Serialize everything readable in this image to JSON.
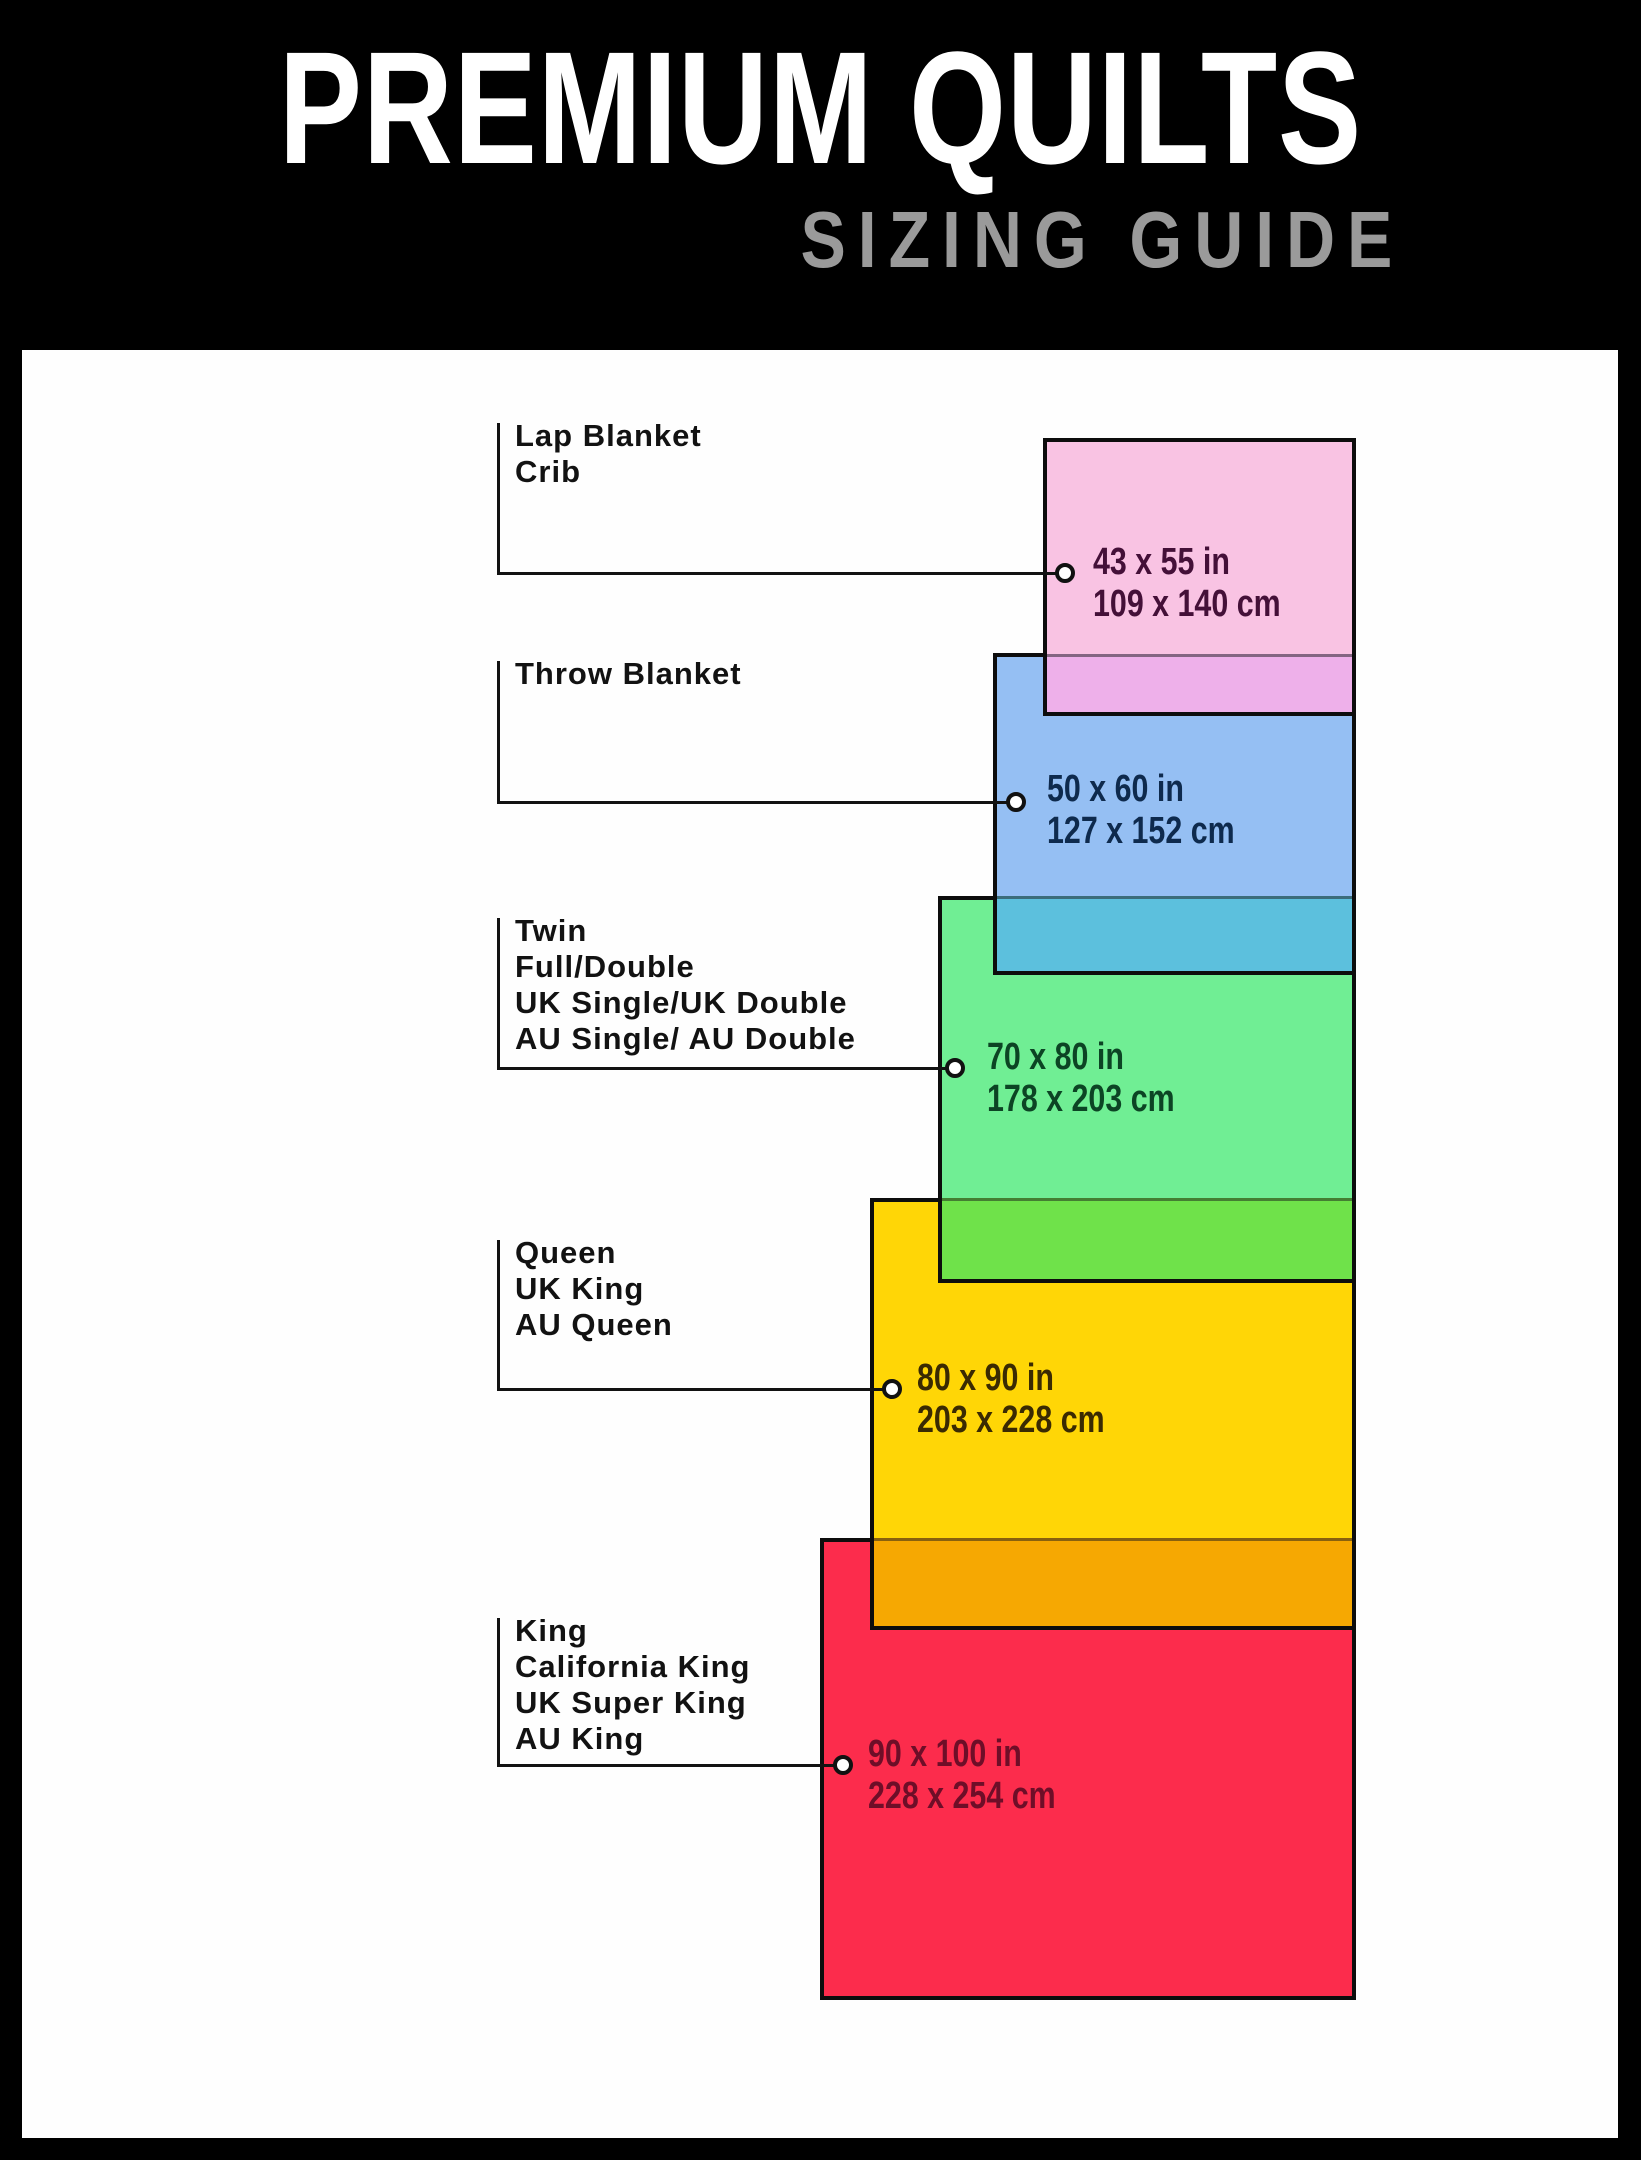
{
  "header": {
    "title": "PREMIUM QUILTS",
    "subtitle": "SIZING GUIDE",
    "title_color": "#ffffff",
    "subtitle_color": "#9a9a9a",
    "background": "#000000"
  },
  "panel": {
    "background": "#fefefe",
    "border_color": "#0d0d0d"
  },
  "quilts": [
    {
      "id": "lap-blanket-crib",
      "names": [
        "Lap Blanket",
        "Crib"
      ],
      "size_in": "43 x 55 in",
      "size_cm": "109 x 140 cm",
      "fill": "#f9c3e3",
      "overlap_fill": "#eeb0ea",
      "text_color": "#441038"
    },
    {
      "id": "throw-blanket",
      "names": [
        "Throw Blanket"
      ],
      "size_in": "50 x 60 in",
      "size_cm": "127 x 152 cm",
      "fill": "#95bff3",
      "overlap_fill": "#5cc0dd",
      "text_color": "#0e2a4d"
    },
    {
      "id": "twin-full-double",
      "names": [
        "Twin",
        "Full/Double",
        "UK Single/UK Double",
        "AU Single/ AU Double"
      ],
      "size_in": "70 x 80 in",
      "size_cm": "178 x 203 cm",
      "fill": "#70ee94",
      "overlap_fill": "#6fe24a",
      "text_color": "#0c4424"
    },
    {
      "id": "queen",
      "names": [
        "Queen",
        "UK King",
        "AU Queen"
      ],
      "size_in": "80 x 90 in",
      "size_cm": "203 x 228 cm",
      "fill": "#ffd606",
      "overlap_fill": "#f6a802",
      "text_color": "#3a2a02"
    },
    {
      "id": "king",
      "names": [
        "King",
        "California King",
        "UK Super King",
        "AU King"
      ],
      "size_in": "90 x 100 in",
      "size_cm": "228 x 254 cm",
      "fill": "#fc2c4c",
      "overlap_fill": null,
      "text_color": "#6e0e28"
    }
  ]
}
